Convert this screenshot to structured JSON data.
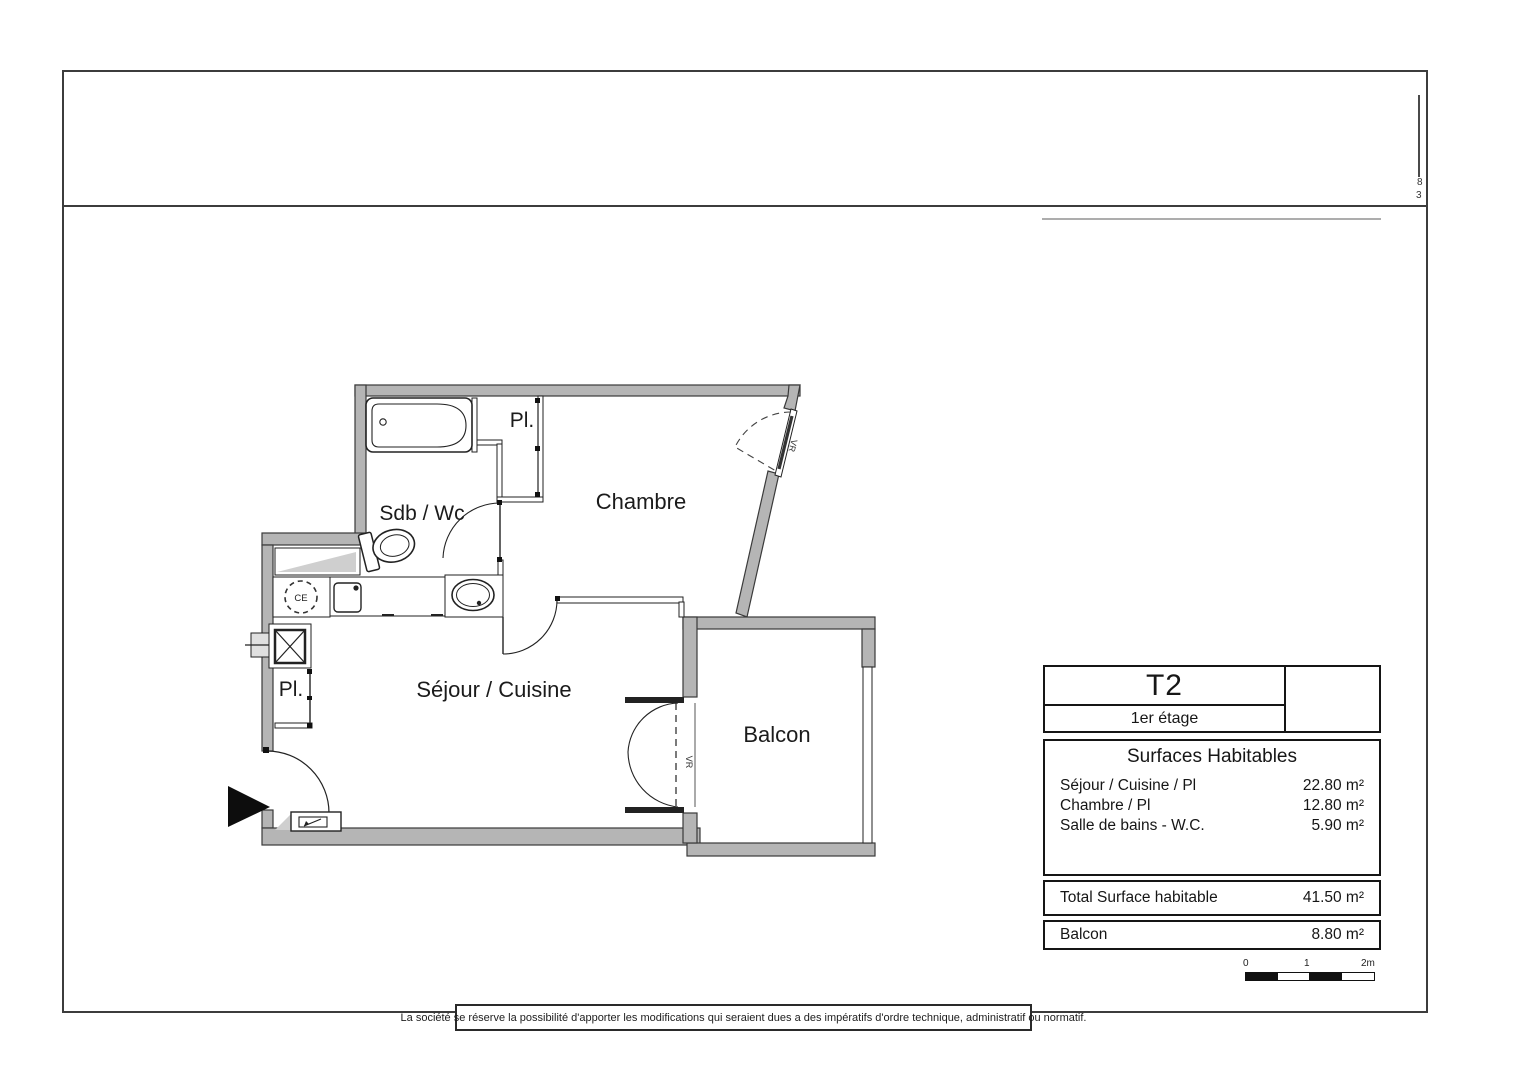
{
  "sheet": {
    "margin_marks": {
      "digit_top": "8",
      "digit_bottom": "3"
    }
  },
  "plan": {
    "rooms": {
      "sdb": "Sdb / Wc",
      "chambre": "Chambre",
      "pl_upper": "Pl.",
      "pl_lower": "Pl.",
      "sejour": "Séjour / Cuisine",
      "balcon": "Balcon"
    },
    "annotations": {
      "ce": "CE",
      "vr_window": "VR",
      "vr_door": "VR"
    },
    "colors": {
      "wall_fill": "#b5b5b5",
      "wall_line": "#3a3a3a",
      "thin_line": "#1f1f1f"
    }
  },
  "info_table": {
    "type_label": "T2",
    "floor_label": "1er étage",
    "surfaces_title": "Surfaces Habitables",
    "rows": [
      {
        "label": "Séjour / Cuisine / Pl",
        "value": "22.80 m²"
      },
      {
        "label": "Chambre / Pl",
        "value": "12.80 m²"
      },
      {
        "label": "Salle de bains - W.C.",
        "value": "5.90 m²"
      }
    ],
    "total": {
      "label": "Total Surface habitable",
      "value": "41.50 m²"
    },
    "balcony": {
      "label": "Balcon",
      "value": "8.80 m²"
    }
  },
  "scale_bar": {
    "labels": [
      "0",
      "1",
      "2m"
    ]
  },
  "footer": {
    "disclaimer": "La société se réserve la possibilité d'apporter les modifications qui seraient dues a des impératifs d'ordre technique, administratif ou normatif."
  }
}
